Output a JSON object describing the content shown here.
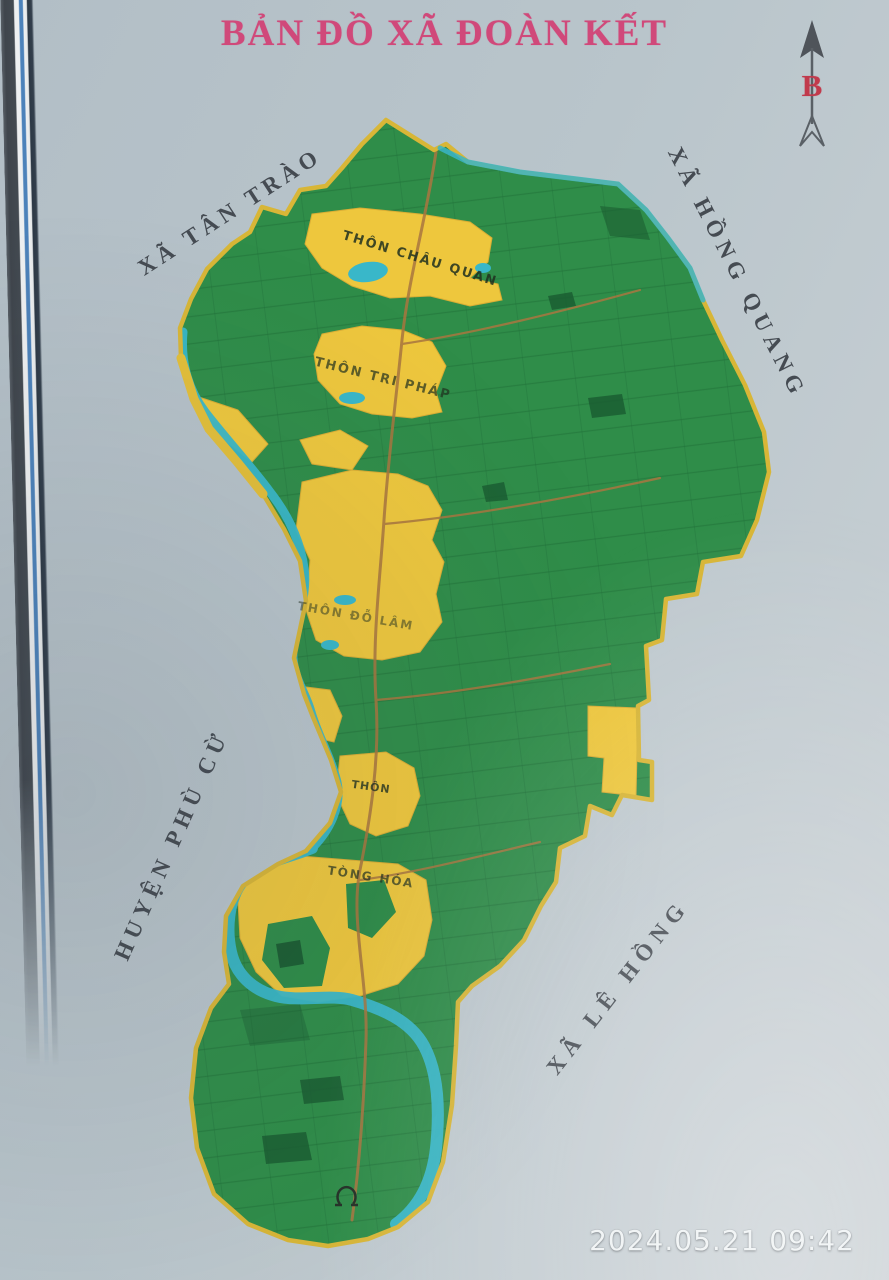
{
  "title": "BẢN ĐỒ XÃ ĐOÀN KẾT",
  "compass": {
    "north_label": "B"
  },
  "neighbors": {
    "tan_trao": "XÃ TÂN TRÀO",
    "hong_quang": "XÃ HỒNG QUANG",
    "phu_cu": "HUYỆN PHÙ CỪ",
    "le_hong": "XÃ LÊ HỒNG"
  },
  "villages": {
    "chau_quan": "THÔN CHÂU QUAN",
    "tri_phap": "THÔN TRI PHÁP",
    "do_lam": "THÔN ĐỖ LÂM",
    "thon": "THÔN",
    "tong_hoa": "TÒNG HÓA"
  },
  "timestamp": "2024.05.21 09:42",
  "palette": {
    "background": "#bcc7cd",
    "title_text": "#d0497a",
    "neighbor_text": "#454b52",
    "village_text": "#20301f",
    "farmland_green": "#2f8d49",
    "field_line_green": "#1f7038",
    "residential_yellow": "#eec73d",
    "water_teal": "#39b7c9",
    "road_brown": "#a9763f",
    "boundary_yellow": "#d8b637",
    "compass_red": "#c13a4c",
    "timestamp_color": "#eef2f3"
  }
}
